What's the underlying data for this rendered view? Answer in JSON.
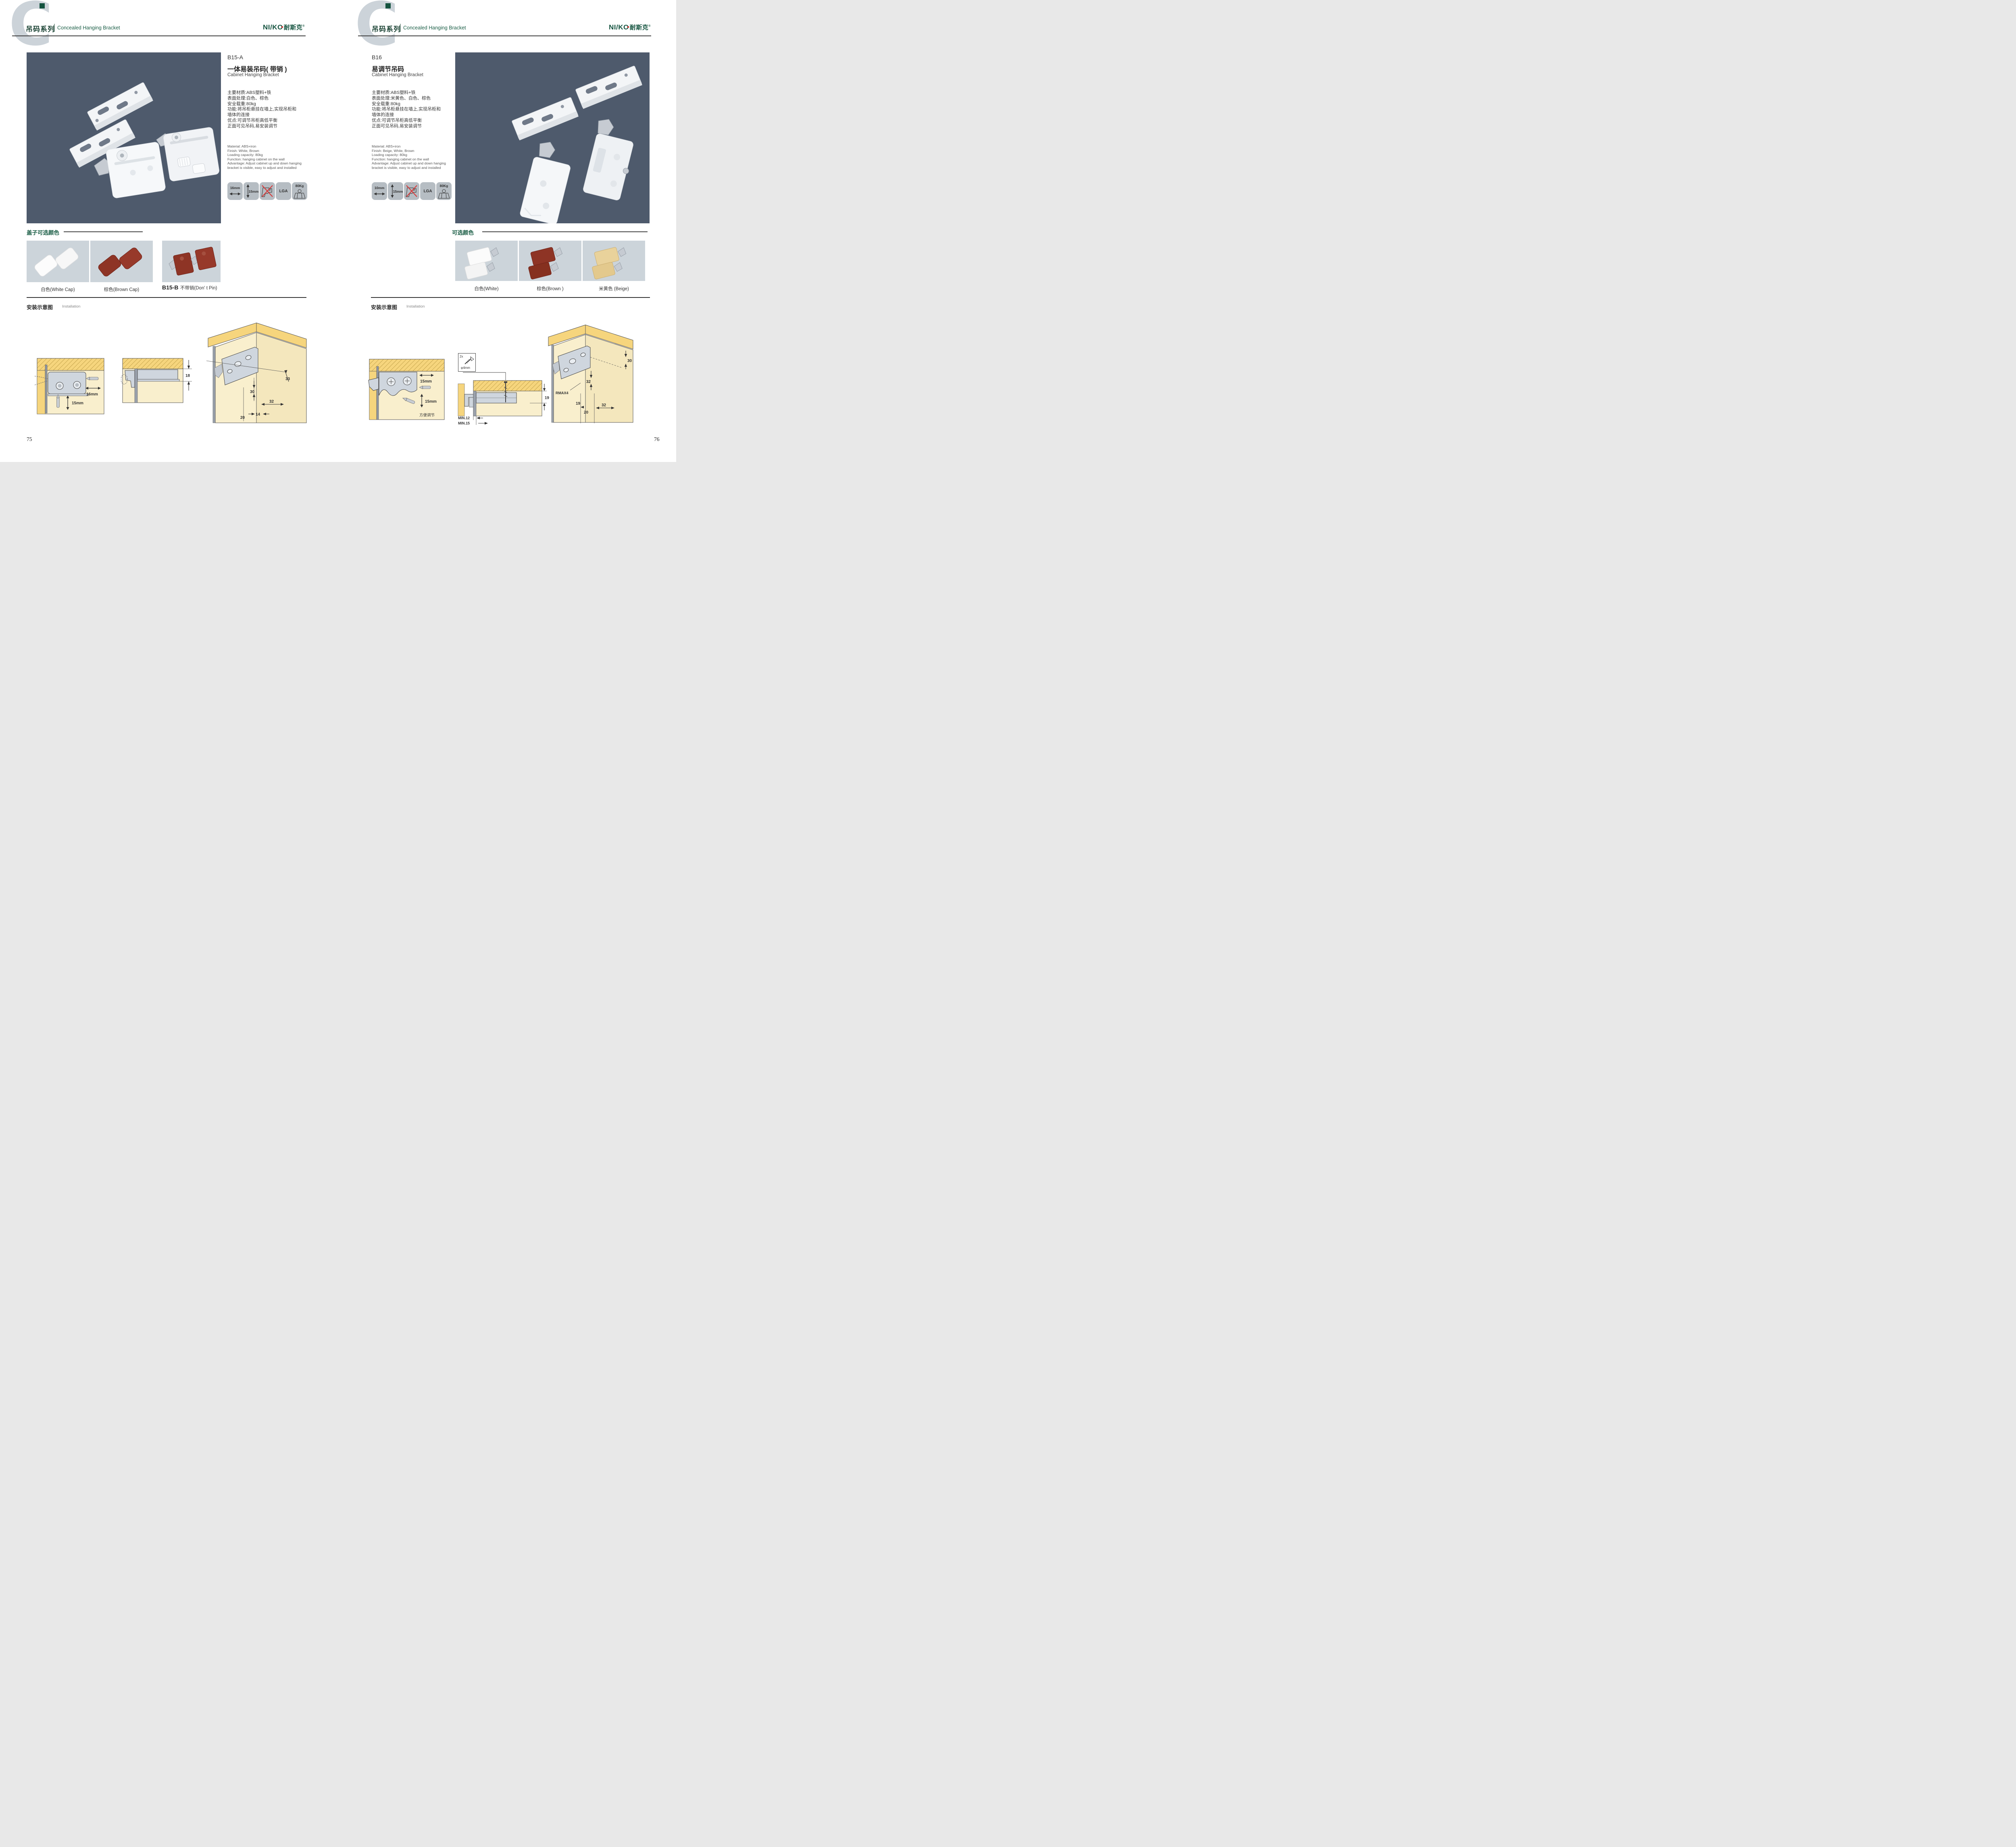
{
  "colors": {
    "accent_green": "#1b5e46",
    "brand_green": "#14533f",
    "photo_bg": "#4e5a6c",
    "swatch_bg": "#ccd4da",
    "icon_tile_gray": "#b6bdc3",
    "wood_yellow": "#f6d57d",
    "panel_cream": "#f9efcd",
    "bracket_gray": "#cfd6de",
    "brown": "#8e3425",
    "beige": "#e9d29b",
    "no_drill_red": "#d63c3c"
  },
  "left": {
    "watermark": "C",
    "header": {
      "series": "吊码系列",
      "subtitle": "Concealed Hanging Bracket"
    },
    "brand": {
      "name": "NI/KO",
      "cn": "耐斯克",
      "reg": "®"
    },
    "product": {
      "code": "B15-A",
      "name_cn": "一体易装吊码( 带销 )",
      "name_en": "Cabinet Hanging Bracket",
      "specs_cn": [
        "主要材质:ABS塑料+铁",
        "表面处理:白色、棕色",
        "安全载重:80kg",
        "功能:将吊柜悬挂在墙上,实现吊柜和",
        "墙体的连接",
        "优点:可调节吊柜高低平衡",
        "正面可见吊码,易安装调节"
      ],
      "specs_en": [
        "Material: ABS+iron",
        "Finish: White, Brown",
        "Loading capacity: 80kg",
        "Function: hanging cabinet on the wall",
        "Advantage: Adjust cabinet up and down hanging",
        "bracket is visible, easy to adjust and installed"
      ]
    },
    "icons": {
      "width": "16mm",
      "height": "15mm",
      "lga": "LGA",
      "load": "80Kg"
    },
    "colors_section": {
      "title": "盖子可选颜色",
      "captions": [
        "白色(White Cap)",
        "棕色(Brown Cap)"
      ],
      "b15b_code": "B15-B",
      "b15b_label": "不带销(Don' t Pin)"
    },
    "install": {
      "title_cn": "安装示意图",
      "title_en": "Installation",
      "d1": {
        "w": "16mm",
        "h": "15mm"
      },
      "d2": {
        "dim": "18"
      },
      "d3": {
        "a": "33",
        "b": "30",
        "c": "32",
        "d": "20",
        "e": "14"
      }
    },
    "page_number": "75"
  },
  "right": {
    "watermark": "C",
    "header": {
      "series": "吊码系列",
      "subtitle": "Concealed Hanging Bracket"
    },
    "brand": {
      "name": "NI/KO",
      "cn": "耐斯克",
      "reg": "®"
    },
    "product": {
      "code": "B16",
      "name_cn": "易调节吊码",
      "name_en": "Cabinet Hanging Bracket",
      "specs_cn": [
        "主要材质:ABS塑料+铁",
        "表面处理:米黄色、白色、棕色",
        "安全载重:80kg",
        "功能:将吊柜悬挂在墙上,实现吊柜和",
        "墙体的连接",
        "优点:可调节吊柜高低平衡",
        "正面可见吊码,易安装调节"
      ],
      "specs_en": [
        "Material: ABS+iron",
        "Finish: Beige, White, Brown",
        "Loading capacity: 80kg",
        "Function: hanging cabinet on the wall",
        "Advantage: Adjust cabinet up and down hanging",
        "bracket is visible, easy to adjust and installed"
      ]
    },
    "icons": {
      "width": "10mm",
      "height": "15mm",
      "lga": "LGA",
      "load": "80Kg"
    },
    "colors_section": {
      "title": "可选颜色",
      "captions": [
        "白色(White)",
        "棕色(Brown )",
        "米黄色 (Beige)"
      ]
    },
    "install": {
      "title_cn": "安装示意图",
      "title_en": "Installation",
      "d1": {
        "w": "15mm",
        "h": "15mm",
        "note": "方便调节"
      },
      "screw": {
        "count": "2x",
        "dia": "φ4mm"
      },
      "d2": {
        "dim": "19",
        "min1": "MIN.12",
        "min2": "MIN.15"
      },
      "d3": {
        "a": "30",
        "b": "32",
        "r": "RMAX4",
        "c": "19",
        "d": "20",
        "e": "32"
      }
    },
    "page_number": "76"
  }
}
